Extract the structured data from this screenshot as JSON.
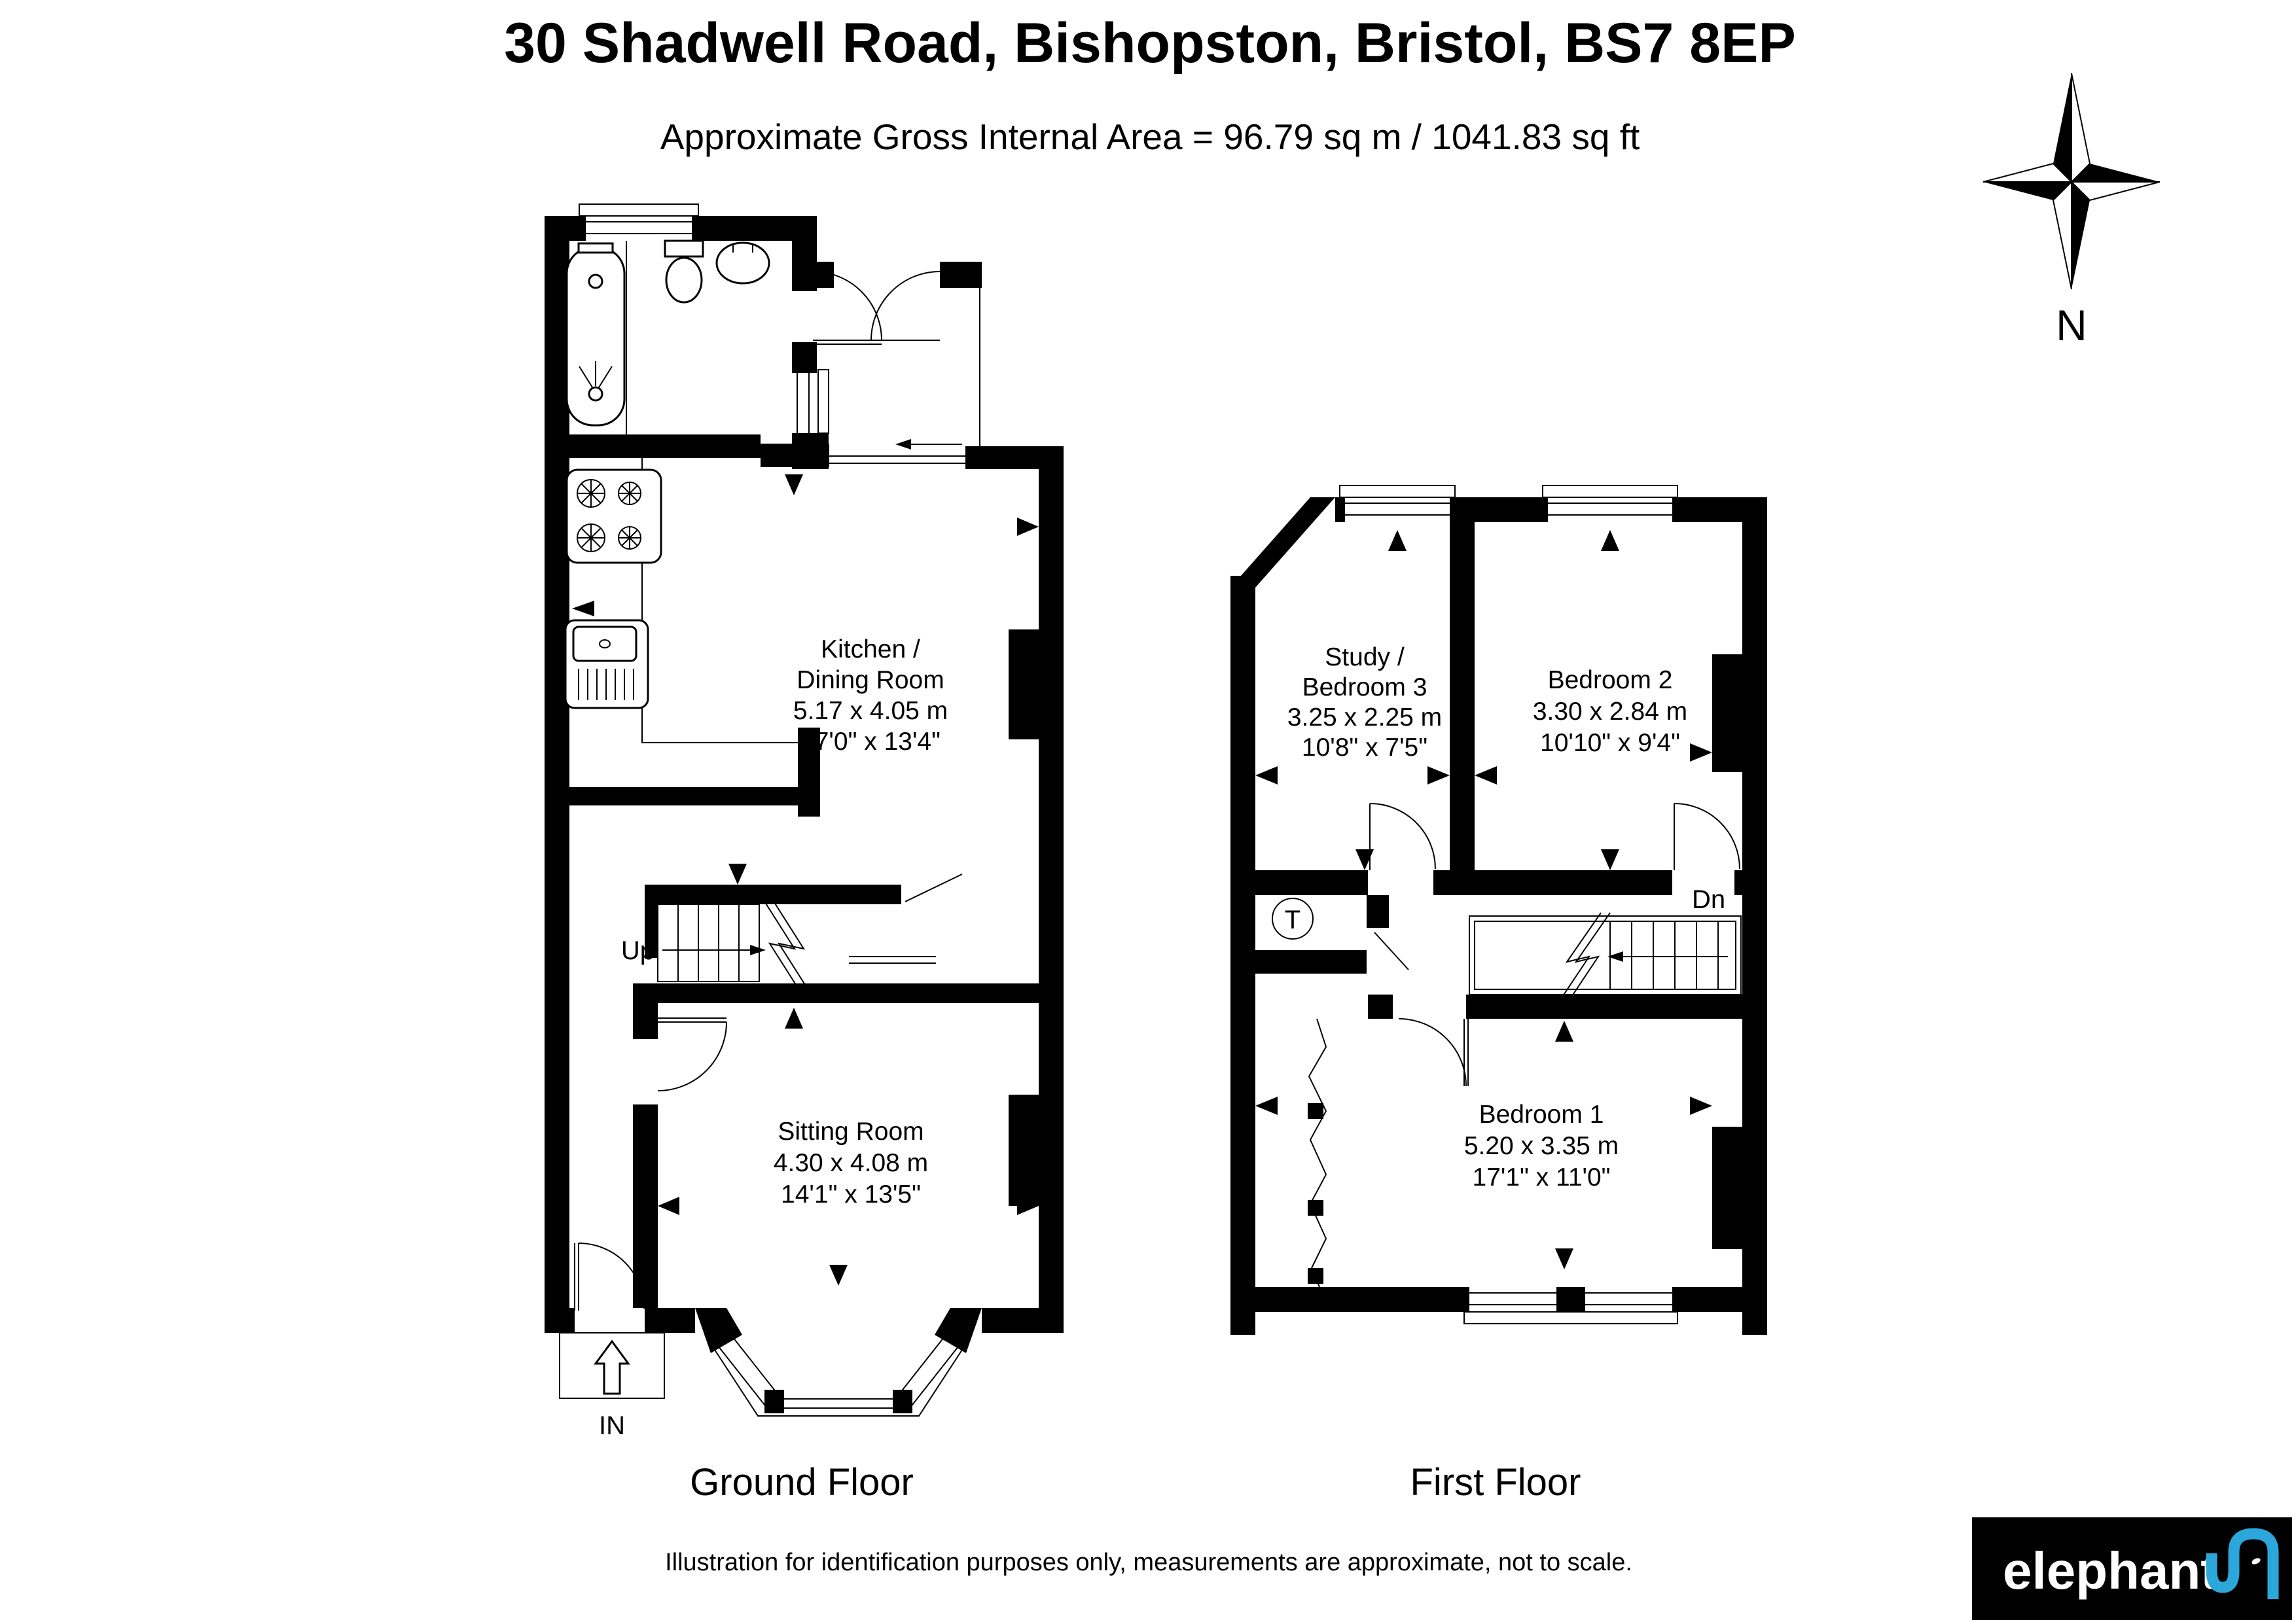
{
  "header": {
    "title": "30 Shadwell Road, Bishopston, Bristol, BS7 8EP",
    "subtitle": "Approximate Gross Internal Area = 96.79 sq m / 1041.83 sq ft"
  },
  "compass": {
    "north_label": "N"
  },
  "ground_floor": {
    "label": "Ground Floor",
    "rooms": {
      "kitchen_dining": {
        "name_line1": "Kitchen /",
        "name_line2": "Dining Room",
        "size_metric": "5.17 x 4.05 m",
        "size_imperial": "17'0\" x 13'4\""
      },
      "sitting_room": {
        "name_line1": "Sitting Room",
        "size_metric": "4.30 x 4.08 m",
        "size_imperial": "14'1\" x 13'5\""
      }
    },
    "annotations": {
      "stairs_up": "Up",
      "entrance": "IN"
    }
  },
  "first_floor": {
    "label": "First Floor",
    "rooms": {
      "study_bedroom3": {
        "name_line1": "Study /",
        "name_line2": "Bedroom 3",
        "size_metric": "3.25 x 2.25 m",
        "size_imperial": "10'8\" x 7'5\""
      },
      "bedroom2": {
        "name_line1": "Bedroom 2",
        "size_metric": "3.30 x 2.84 m",
        "size_imperial": "10'10\" x 9'4\""
      },
      "bedroom1": {
        "name_line1": "Bedroom 1",
        "size_metric": "5.20 x 3.35 m",
        "size_imperial": "17'1\" x 11'0\""
      }
    },
    "annotations": {
      "stairs_down": "Dn",
      "tank": "T"
    }
  },
  "footer": {
    "disclaimer": "Illustration for identification purposes only, measurements are approximate, not to scale."
  },
  "logo": {
    "brand": "elephant",
    "accent_color": "#2BA7DC",
    "background": "#000000"
  }
}
